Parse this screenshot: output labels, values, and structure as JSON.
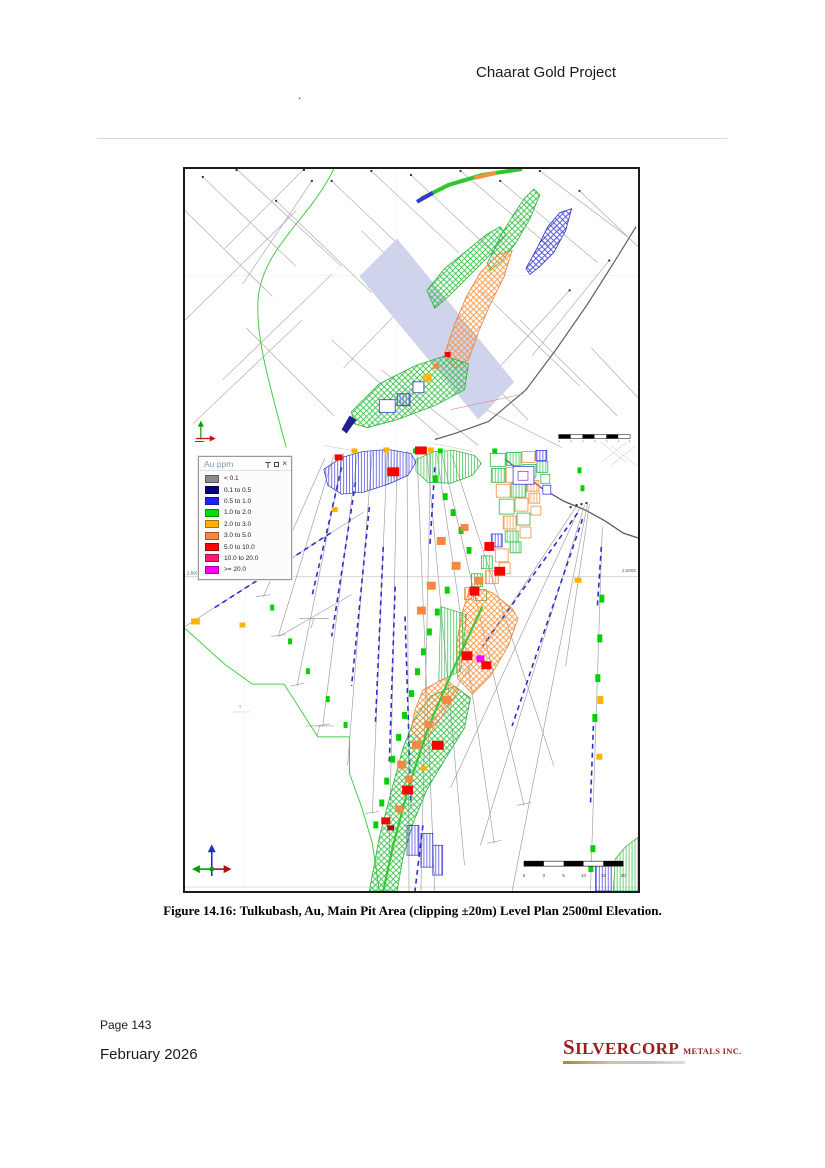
{
  "page": {
    "header_title": "Chaarat Gold Project",
    "stray_mark": ".",
    "caption": "Figure 14.16: Tulkubash, Au, Main Pit Area (clipping ±20m) Level Plan 2500ml Elevation.",
    "page_number": "Page 143",
    "date": "February 2026"
  },
  "logo": {
    "name": "SILVERCORP",
    "suffix": "METALS INC.",
    "color": "#9a1a1d"
  },
  "legend": {
    "title": "Au ppm",
    "window_icons": [
      "pin",
      "restore",
      "close"
    ],
    "entries": [
      {
        "label": "< 0.1",
        "color": "#8a8a8a"
      },
      {
        "label": "0.1 to 0.5",
        "color": "#000080"
      },
      {
        "label": "0.5 to 1.0",
        "color": "#2222ff"
      },
      {
        "label": "1.0 to 2.0",
        "color": "#00e000"
      },
      {
        "label": "2.0 to 3.0",
        "color": "#ffb300"
      },
      {
        "label": "3.0 to 5.0",
        "color": "#f8873f"
      },
      {
        "label": "5.0 to 10.0",
        "color": "#fe0000"
      },
      {
        "label": "10.0 to 20.0",
        "color": "#ff1a75"
      },
      {
        "label": ">= 20.0",
        "color": "#ff00ff"
      }
    ]
  },
  "map": {
    "elevation_left": "2,500",
    "elevation_right": "2,500Z",
    "axis_label": "Y",
    "scale_bar_labels": [
      "5",
      "0",
      "5",
      "10",
      "15",
      "20"
    ]
  }
}
